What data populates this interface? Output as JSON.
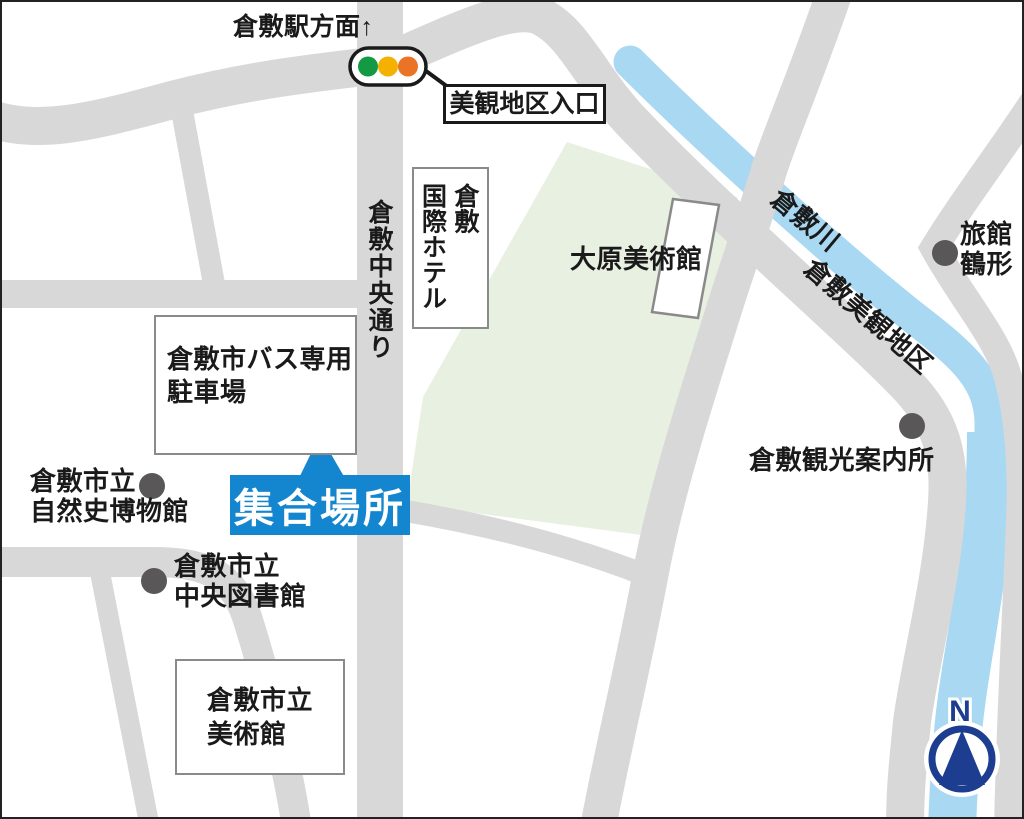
{
  "header": {
    "station_direction": "倉敷駅方面↑"
  },
  "signal": {
    "icon": "traffic-light-icon",
    "callout": "美観地区入口"
  },
  "roads": {
    "chuo_dori": "倉敷中央通り"
  },
  "river": {
    "name": "倉敷川",
    "district": "倉敷美観地区"
  },
  "places": {
    "kokusai_hotel": "倉敷\n国際ホテル",
    "ohara_museum": "大原美術館",
    "ryokan_tsurugata": "旅館\n鶴形",
    "bus_parking": "倉敷市バス専用\n駐車場",
    "meeting_point": "集合場所",
    "natural_history_museum": "倉敷市立\n自然史博物館",
    "central_library": "倉敷市立\n中央図書館",
    "city_art_museum": "倉敷市立\n美術館",
    "tourist_info": "倉敷観光案内所"
  },
  "compass": {
    "north": "N"
  },
  "colors": {
    "road": "#d8d8d8",
    "river": "#a9d8f3",
    "park": "#e8f0e1",
    "accent_blue": "#1486cf",
    "compass_navy": "#1c3d90",
    "marker_gray": "#595757",
    "signal_green": "#149a43",
    "signal_amber": "#f4b100",
    "signal_orange": "#ea7325"
  }
}
